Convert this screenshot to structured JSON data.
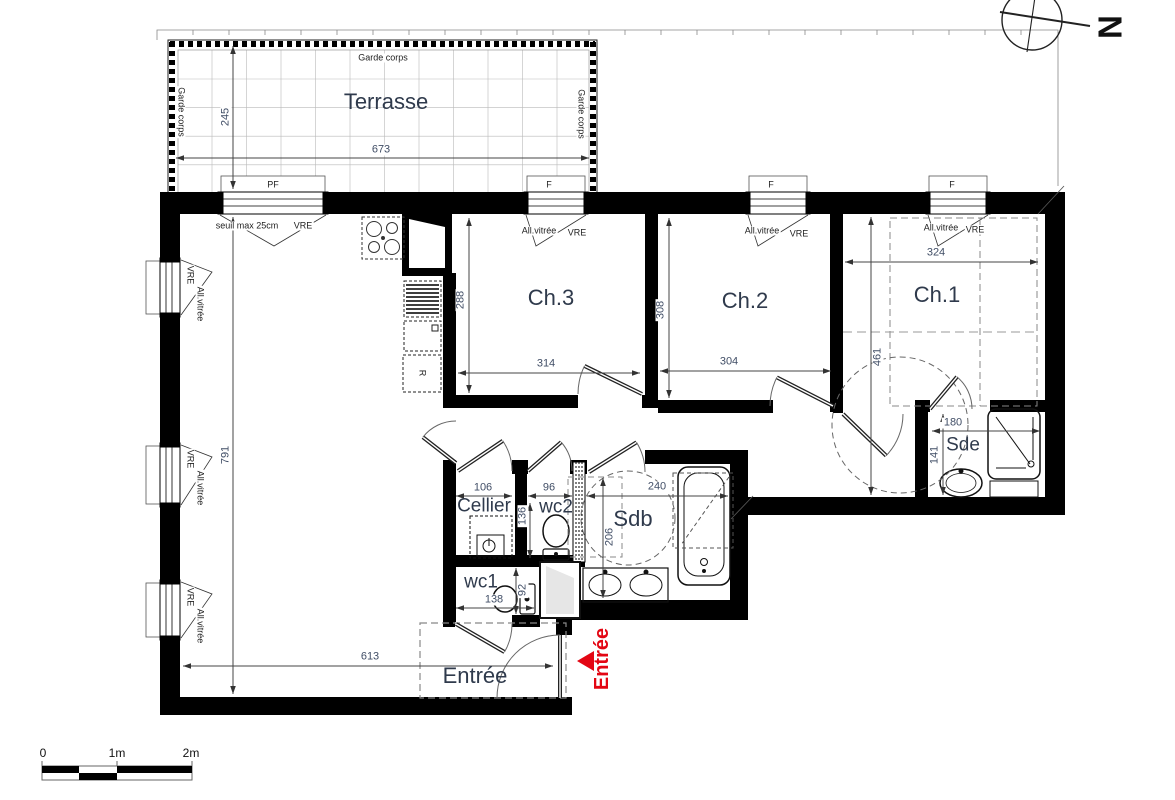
{
  "colors": {
    "wall": "#000000",
    "line": "#333333",
    "dim_text": "#414e66",
    "room_text": "#2f3a4c",
    "entrance_red": "#e30613",
    "grid": "#b9b9b9"
  },
  "compass": {
    "label": "N"
  },
  "scale_bar": {
    "labels": [
      "0",
      "1m",
      "2m"
    ]
  },
  "entrance_marker": {
    "label": "Entrée"
  },
  "rooms": [
    {
      "label": "Terrasse",
      "x": 386,
      "y": 102,
      "cls": "room"
    },
    {
      "label": "Ch.3",
      "x": 551,
      "y": 298,
      "cls": "room"
    },
    {
      "label": "Ch.2",
      "x": 745,
      "y": 301,
      "cls": "room"
    },
    {
      "label": "Ch.1",
      "x": 937,
      "y": 295,
      "cls": "room"
    },
    {
      "label": "Sde",
      "x": 963,
      "y": 445,
      "cls": "room-sm"
    },
    {
      "label": "Sdb",
      "x": 633,
      "y": 519,
      "cls": "room"
    },
    {
      "label": "wc2",
      "x": 556,
      "y": 507,
      "cls": "room-sm"
    },
    {
      "label": "Cellier",
      "x": 484,
      "y": 506,
      "cls": "room-sm"
    },
    {
      "label": "wc1",
      "x": 481,
      "y": 582,
      "cls": "room-sm"
    },
    {
      "label": "Entrée",
      "x": 475,
      "y": 676,
      "cls": "room"
    }
  ],
  "annotations": [
    {
      "text": "Garde corps",
      "x": 383,
      "y": 58,
      "rot": 0
    },
    {
      "text": "Garde corps",
      "x": 181,
      "y": 112,
      "rot": 90
    },
    {
      "text": "Garde corps",
      "x": 581,
      "y": 114,
      "rot": 90
    },
    {
      "text": "PF",
      "x": 273,
      "y": 185,
      "rot": 0
    },
    {
      "text": "F",
      "x": 549,
      "y": 185,
      "rot": 0
    },
    {
      "text": "F",
      "x": 771,
      "y": 185,
      "rot": 0
    },
    {
      "text": "F",
      "x": 952,
      "y": 185,
      "rot": 0
    },
    {
      "text": "seuil max 25cm",
      "x": 247,
      "y": 226,
      "rot": 0
    },
    {
      "text": "VRE",
      "x": 303,
      "y": 226,
      "rot": 0
    },
    {
      "text": "All.vitrée",
      "x": 539,
      "y": 231,
      "rot": 0
    },
    {
      "text": "VRE",
      "x": 577,
      "y": 233,
      "rot": 0
    },
    {
      "text": "All.vitrée",
      "x": 762,
      "y": 231,
      "rot": 0
    },
    {
      "text": "VRE",
      "x": 799,
      "y": 234,
      "rot": 0
    },
    {
      "text": "All.vitrée",
      "x": 941,
      "y": 228,
      "rot": 0
    },
    {
      "text": "VRE",
      "x": 975,
      "y": 230,
      "rot": 0
    },
    {
      "text": "VRE",
      "x": 190,
      "y": 275,
      "rot": 90
    },
    {
      "text": "All.vitrée",
      "x": 200,
      "y": 304,
      "rot": 90
    },
    {
      "text": "VRE",
      "x": 190,
      "y": 459,
      "rot": 90
    },
    {
      "text": "All.vitrée",
      "x": 200,
      "y": 488,
      "rot": 90
    },
    {
      "text": "VRE",
      "x": 190,
      "y": 597,
      "rot": 90
    },
    {
      "text": "All.vitrée",
      "x": 200,
      "y": 626,
      "rot": 90
    },
    {
      "text": "R",
      "x": 422,
      "y": 373,
      "rot": 90
    }
  ],
  "dimensions": [
    {
      "value": "245",
      "x1": 233,
      "y1": 46,
      "x2": 233,
      "y2": 189,
      "lx": 226,
      "ly": 117,
      "rot": -90
    },
    {
      "value": "673",
      "x1": 176,
      "y1": 158,
      "x2": 589,
      "y2": 158,
      "lx": 381,
      "ly": 150,
      "rot": 0
    },
    {
      "value": "791",
      "x1": 233,
      "y1": 217,
      "x2": 233,
      "y2": 694,
      "lx": 226,
      "ly": 455,
      "rot": -90
    },
    {
      "value": "613",
      "x1": 183,
      "y1": 666,
      "x2": 553,
      "y2": 666,
      "lx": 370,
      "ly": 657,
      "rot": 0
    },
    {
      "value": "288",
      "x1": 469,
      "y1": 218,
      "x2": 469,
      "y2": 393,
      "lx": 461,
      "ly": 300,
      "rot": -90
    },
    {
      "value": "314",
      "x1": 458,
      "y1": 373,
      "x2": 640,
      "y2": 373,
      "lx": 546,
      "ly": 364,
      "rot": 0
    },
    {
      "value": "308",
      "x1": 669,
      "y1": 218,
      "x2": 669,
      "y2": 398,
      "lx": 661,
      "ly": 310,
      "rot": -90
    },
    {
      "value": "304",
      "x1": 660,
      "y1": 371,
      "x2": 831,
      "y2": 371,
      "lx": 729,
      "ly": 362,
      "rot": 0
    },
    {
      "value": "324",
      "x1": 845,
      "y1": 262,
      "x2": 1038,
      "y2": 262,
      "lx": 936,
      "ly": 253,
      "rot": 0
    },
    {
      "value": "461",
      "x1": 871,
      "y1": 217,
      "x2": 871,
      "y2": 495,
      "lx": 878,
      "ly": 357,
      "rot": -90
    },
    {
      "value": "180",
      "x1": 932,
      "y1": 431,
      "x2": 1040,
      "y2": 431,
      "lx": 953,
      "ly": 423,
      "rot": 0
    },
    {
      "value": "141",
      "x1": 943,
      "y1": 414,
      "x2": 943,
      "y2": 495,
      "lx": 935,
      "ly": 455,
      "rot": -90
    },
    {
      "value": "106",
      "x1": 456,
      "y1": 496,
      "x2": 512,
      "y2": 496,
      "lx": 483,
      "ly": 488,
      "rot": 0
    },
    {
      "value": "96",
      "x1": 528,
      "y1": 496,
      "x2": 572,
      "y2": 496,
      "lx": 549,
      "ly": 488,
      "rot": 0
    },
    {
      "value": "240",
      "x1": 587,
      "y1": 496,
      "x2": 728,
      "y2": 496,
      "lx": 657,
      "ly": 487,
      "rot": 0
    },
    {
      "value": "136",
      "x1": 530,
      "y1": 503,
      "x2": 530,
      "y2": 558,
      "lx": 523,
      "ly": 516,
      "rot": -90
    },
    {
      "value": "206",
      "x1": 603,
      "y1": 478,
      "x2": 603,
      "y2": 598,
      "lx": 610,
      "ly": 537,
      "rot": -90
    },
    {
      "value": "138",
      "x1": 456,
      "y1": 608,
      "x2": 534,
      "y2": 608,
      "lx": 494,
      "ly": 600,
      "rot": 0
    },
    {
      "value": "92",
      "x1": 516,
      "y1": 568,
      "x2": 516,
      "y2": 614,
      "lx": 523,
      "ly": 590,
      "rot": -90
    }
  ]
}
